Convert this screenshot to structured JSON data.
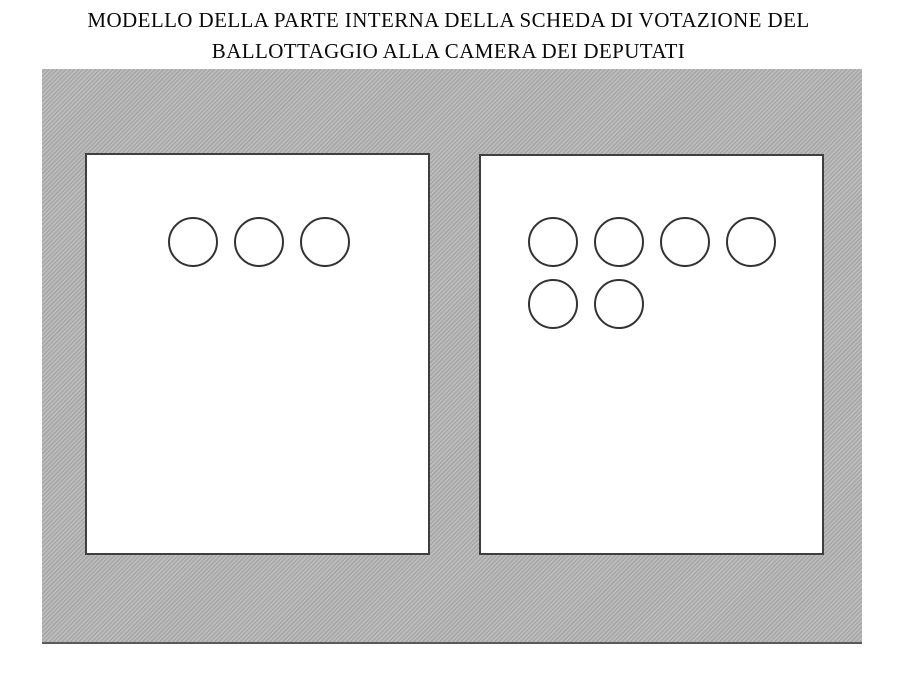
{
  "page": {
    "title_line1": "MODELLO DELLA PARTE INTERNA DELLA SCHEDA DI VOTAZIONE DEL",
    "title_line2": "BALLOTTAGGIO ALLA CAMERA DEI DEPUTATI"
  },
  "ballot": {
    "left_panel": {
      "circle_rows": [
        3
      ],
      "total_circles": 3
    },
    "right_panel": {
      "circle_rows": [
        4,
        2
      ],
      "total_circles": 6
    },
    "colors": {
      "hatch_light": "#bdbdbd",
      "hatch_dark": "#a7a7a7",
      "hatch_bottom_edge": "#5a5a5a",
      "panel_background": "#ffffff",
      "panel_border": "#3f3f3f",
      "circle_border": "#333333",
      "title_color": "#0a0a0a"
    }
  }
}
